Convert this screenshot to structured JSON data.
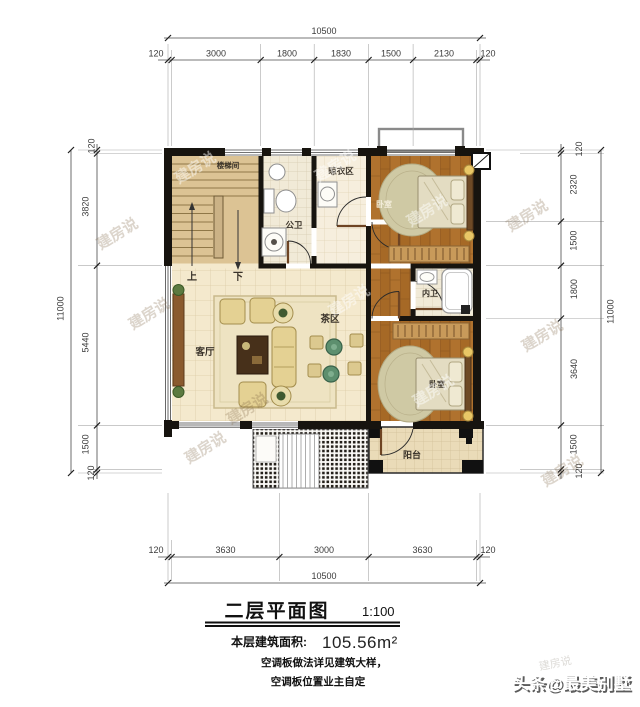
{
  "plan": {
    "rooms": {
      "stairwell": "楼梯间",
      "public_bath": "公卫",
      "drying_area": "晾衣区",
      "bedroom_top": "卧室",
      "inner_bath": "内卫",
      "bedroom_bottom": "卧室",
      "living_room": "客厅",
      "tea_area": "茶区",
      "balcony": "阳台",
      "stair_up": "上",
      "stair_down": "下"
    },
    "dimensions": {
      "top": {
        "total": "10500",
        "segments": [
          "120",
          "3000",
          "1800",
          "1830",
          "1500",
          "2130",
          "120"
        ]
      },
      "bottom": {
        "total": "10500",
        "segments": [
          "120",
          "3630",
          "3000",
          "3630",
          "120"
        ]
      },
      "left": {
        "total": "11000",
        "segments": [
          "120",
          "3820",
          "5440",
          "1500",
          "120"
        ]
      },
      "right": {
        "total": "11000",
        "segments": [
          "120",
          "2320",
          "1500",
          "1800",
          "3640",
          "1500",
          "120"
        ]
      }
    }
  },
  "title_block": {
    "title": "二层平面图",
    "scale": "1:100",
    "area_label": "本层建筑面积:",
    "area_value": "105.56m²",
    "note_line1": "空调板做法详见建筑大样，",
    "note_line2": "空调板位置业主自定"
  },
  "watermark": {
    "brand": "建房说",
    "credit": "头条@最美别墅"
  },
  "colors": {
    "wall": "#17140f",
    "wood_floor": "#b0722e",
    "tile_floor": "#f4e9cd",
    "stair_floor": "#dcc394",
    "tea_table_green": "#5d8f6e",
    "sofa_beige": "#e4d193"
  }
}
